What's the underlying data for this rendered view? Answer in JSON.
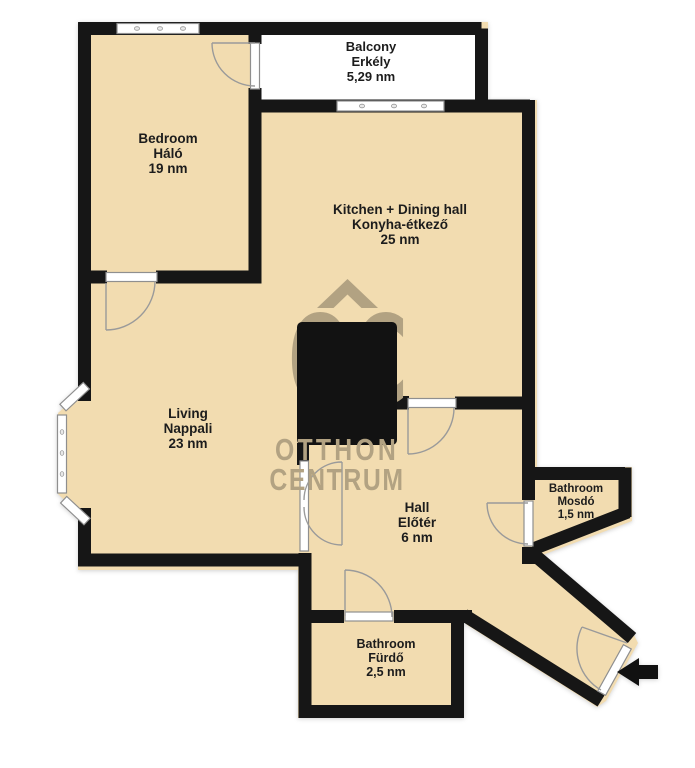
{
  "plan": {
    "type": "apartment floor plan",
    "watermark": {
      "initials": "OC",
      "line1": "OTTHON",
      "line2": "CENTRUM"
    },
    "colors": {
      "floor": "#f2dcb0",
      "wall": "#161616",
      "balcony_floor": "#ffffff",
      "watermark": "#b2a282",
      "window_frame": "#8f8f8f",
      "door_arc": "#9a9a9a",
      "label_text": "#1c1c1c"
    },
    "icons": {
      "entrance_arrow": "left-arrow"
    }
  },
  "rooms": [
    {
      "id": "balcony",
      "name_en": "Balcony",
      "name_hu": "Erkély",
      "area": "5,29 nm"
    },
    {
      "id": "bedroom",
      "name_en": "Bedroom",
      "name_hu": "Háló",
      "area": "19 nm"
    },
    {
      "id": "kitchen",
      "name_en": "Kitchen + Dining hall",
      "name_hu": "Konyha-étkező",
      "area": "25 nm"
    },
    {
      "id": "living",
      "name_en": "Living",
      "name_hu": "Nappali",
      "area": "23 nm"
    },
    {
      "id": "hall",
      "name_en": "Hall",
      "name_hu": "Előtér",
      "area": "6 nm"
    },
    {
      "id": "bathroom-mosdo",
      "name_en": "Bathroom",
      "name_hu": "Mosdó",
      "area": "1,5 nm"
    },
    {
      "id": "bathroom-furdo",
      "name_en": "Bathroom",
      "name_hu": "Fürdő",
      "area": "2,5 nm"
    }
  ]
}
